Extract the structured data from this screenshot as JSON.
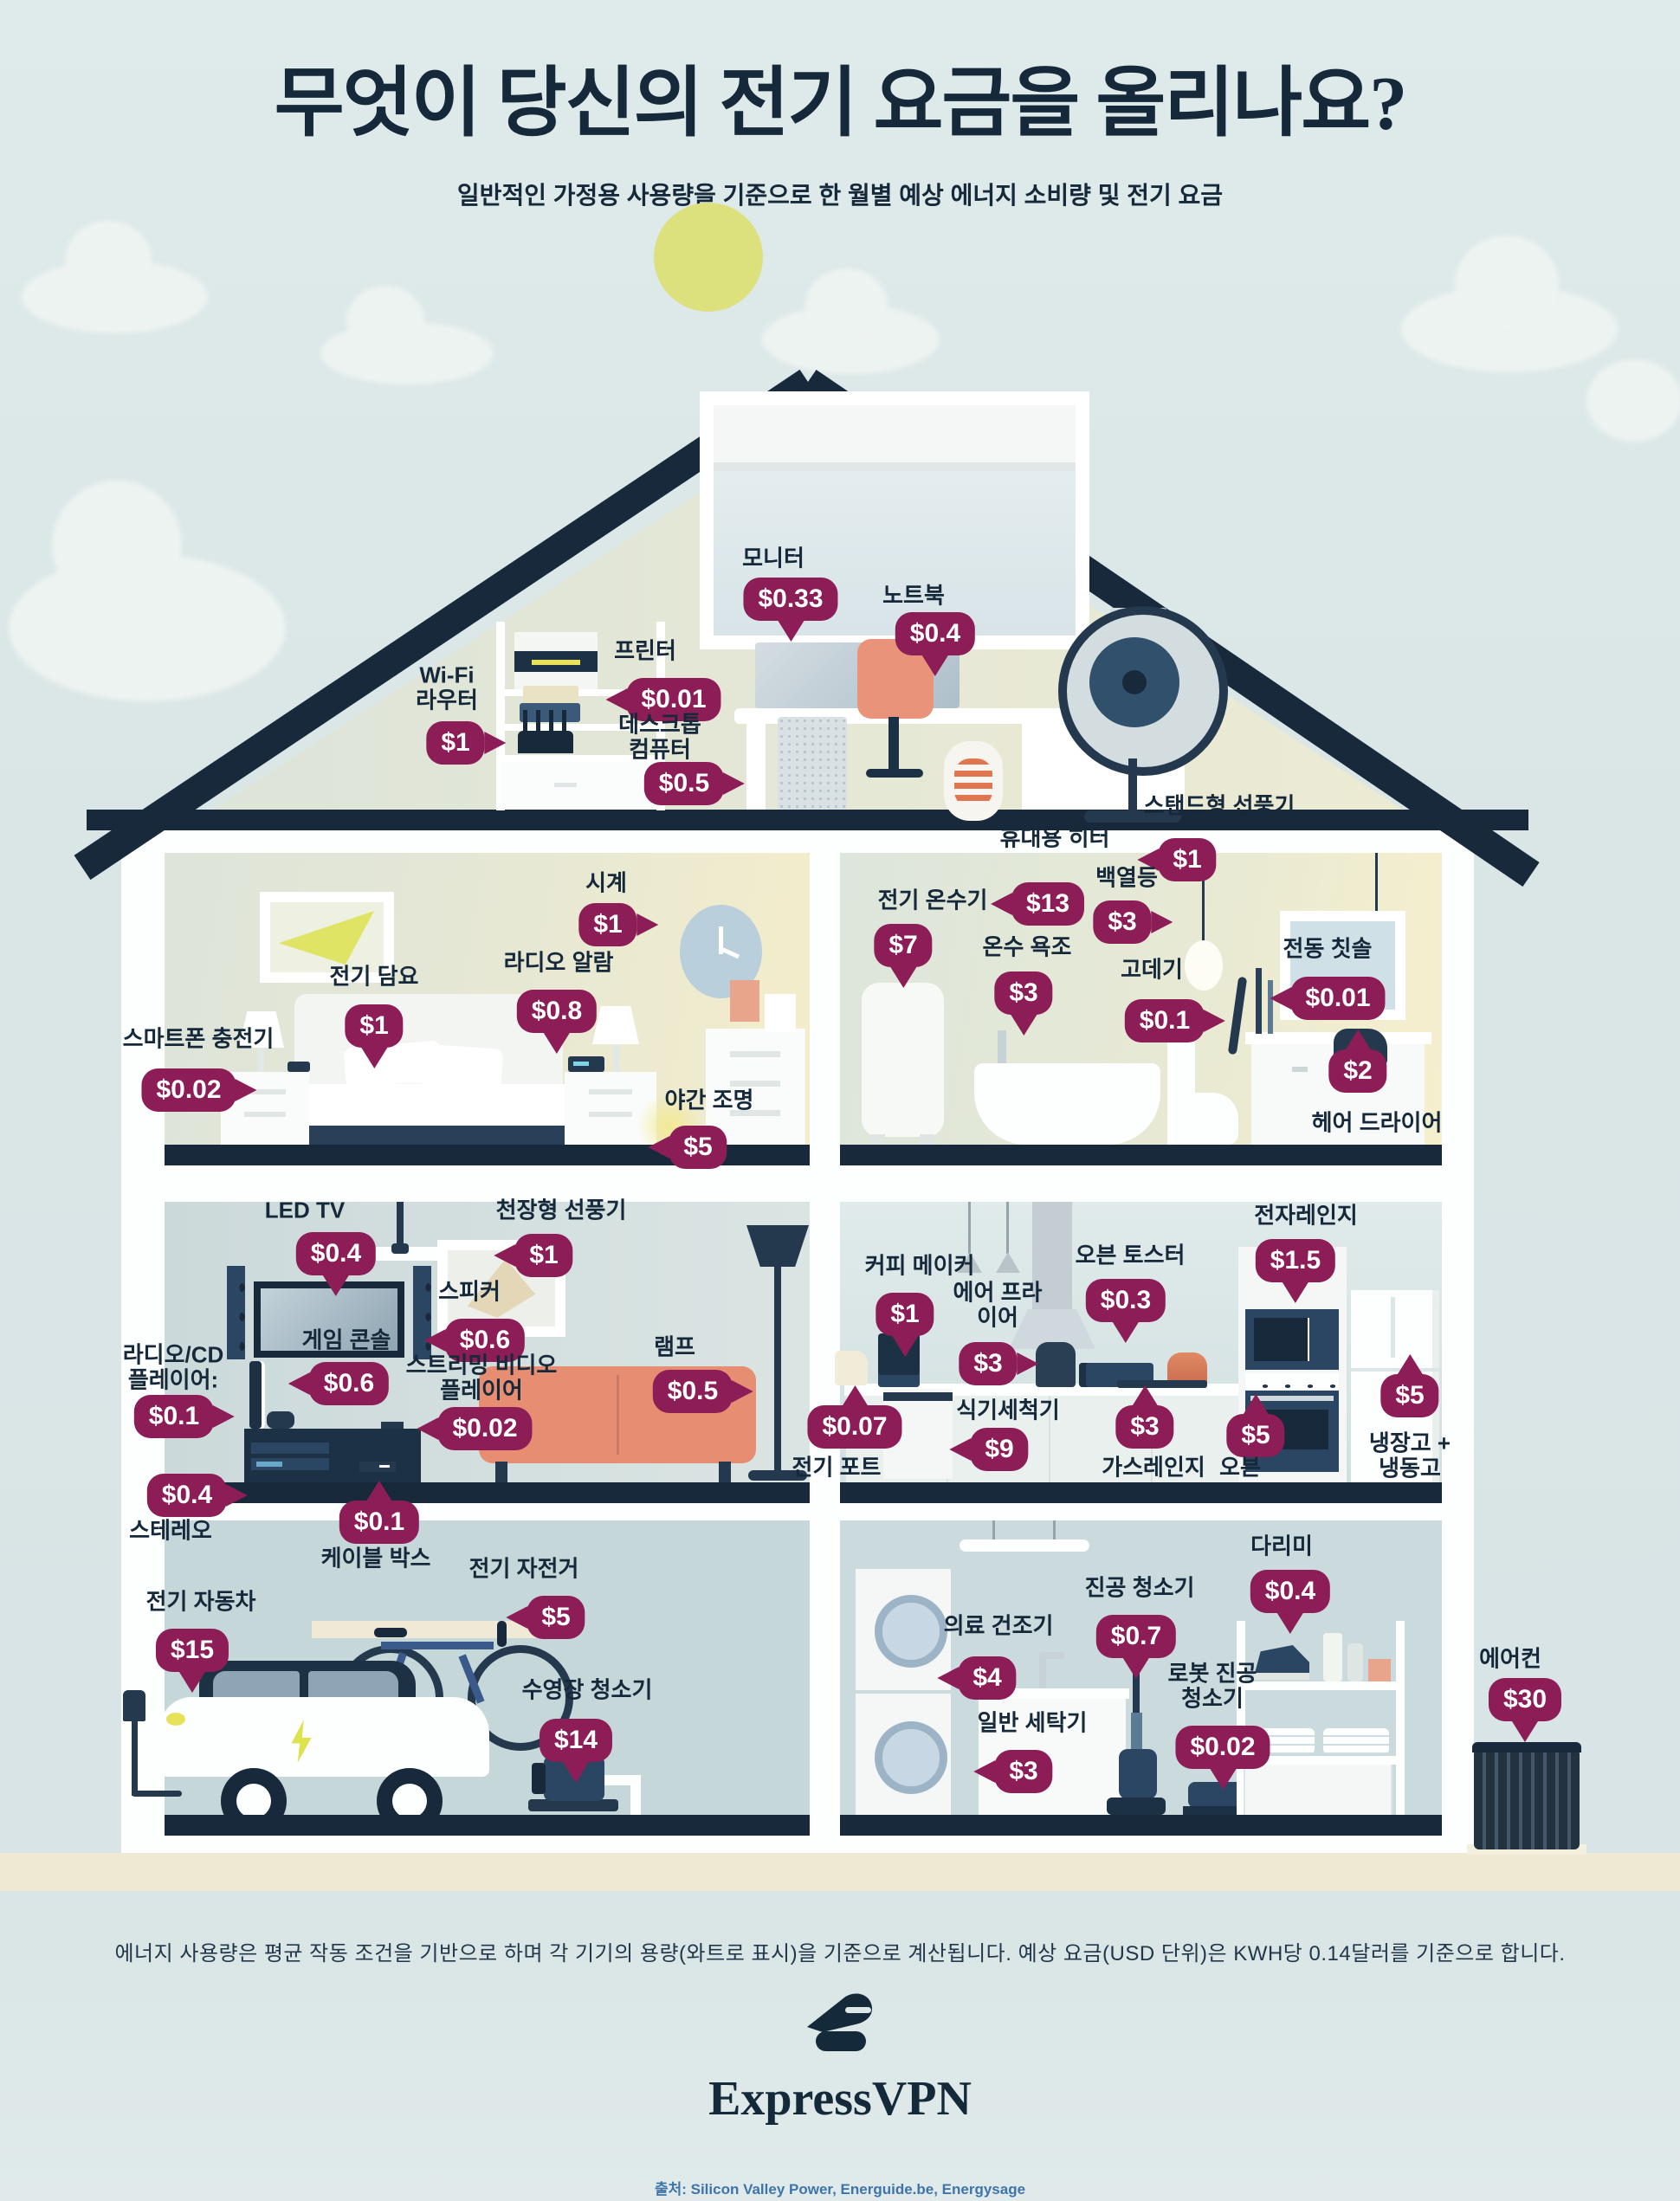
{
  "header": {
    "title": "무엇이 당신의 전기 요금을 올리나요?",
    "subtitle": "일반적인 가정용 사용량을 기준으로 한 월별 예상 에너지 소비량 및 전기 요금"
  },
  "items": [
    {
      "id": "monitor",
      "label": "모니터",
      "price": "$0.33"
    },
    {
      "id": "printer",
      "label": "프린터",
      "price": "$0.01"
    },
    {
      "id": "laptop",
      "label": "노트북",
      "price": "$0.4"
    },
    {
      "id": "wifi-router",
      "label": "Wi-Fi\n라우터",
      "price": "$1"
    },
    {
      "id": "desktop-computer",
      "label": "데스크톱\n컴퓨터",
      "price": "$0.5"
    },
    {
      "id": "portable-heater",
      "label": "휴대용 히터",
      "price": "$13"
    },
    {
      "id": "stand-fan",
      "label": "스탠드형 선풍기",
      "price": "$1"
    },
    {
      "id": "clock",
      "label": "시계",
      "price": "$1"
    },
    {
      "id": "electric-blanket",
      "label": "전기 담요",
      "price": "$1"
    },
    {
      "id": "radio-alarm",
      "label": "라디오 알람",
      "price": "$0.8"
    },
    {
      "id": "smartphone-charger",
      "label": "스마트폰 충전기",
      "price": "$0.02"
    },
    {
      "id": "night-light",
      "label": "야간 조명",
      "price": "$5"
    },
    {
      "id": "electric-water-heater",
      "label": "전기 온수기",
      "price": "$7"
    },
    {
      "id": "incandescent-bulb",
      "label": "백열등",
      "price": "$3"
    },
    {
      "id": "hot-tub",
      "label": "온수 욕조",
      "price": "$3"
    },
    {
      "id": "hair-straightener",
      "label": "고데기",
      "price": "$0.1"
    },
    {
      "id": "electric-toothbrush",
      "label": "전동 칫솔",
      "price": "$0.01"
    },
    {
      "id": "hair-dryer",
      "label": "헤어 드라이어",
      "price": "$2"
    },
    {
      "id": "led-tv",
      "label": "LED TV",
      "price": "$0.4"
    },
    {
      "id": "ceiling-fan",
      "label": "천장형 선풍기",
      "price": "$1"
    },
    {
      "id": "speakers",
      "label": "스피커",
      "price": "$0.6"
    },
    {
      "id": "game-console",
      "label": "게임 콘솔",
      "price": "$0.6"
    },
    {
      "id": "lamp",
      "label": "램프",
      "price": "$0.5"
    },
    {
      "id": "radio-cd-player",
      "label": "라디오/CD\n플레이어:",
      "price": "$0.1"
    },
    {
      "id": "stereo",
      "label": "스테레오",
      "price": "$0.4"
    },
    {
      "id": "streaming-player",
      "label": "스트리밍 비디오\n플레이어",
      "price": "$0.02"
    },
    {
      "id": "cable-box",
      "label": "케이블 박스",
      "price": "$0.1"
    },
    {
      "id": "coffee-maker",
      "label": "커피 메이커",
      "price": "$1"
    },
    {
      "id": "microwave",
      "label": "전자레인지",
      "price": "$1.5"
    },
    {
      "id": "oven-toaster",
      "label": "오븐 토스터",
      "price": "$0.3"
    },
    {
      "id": "air-fryer",
      "label": "에어 프라\n이어",
      "price": "$3"
    },
    {
      "id": "electric-kettle",
      "label": "전기 포트",
      "price": "$0.07"
    },
    {
      "id": "dishwasher",
      "label": "식기세척기",
      "price": "$9"
    },
    {
      "id": "gas-range",
      "label": "가스레인지",
      "price": "$3"
    },
    {
      "id": "oven",
      "label": "오븐",
      "price": "$5"
    },
    {
      "id": "fridge-freezer",
      "label": "냉장고 +\n냉동고",
      "price": "$5"
    },
    {
      "id": "electric-car",
      "label": "전기 자동차",
      "price": "$15"
    },
    {
      "id": "electric-bike",
      "label": "전기 자전거",
      "price": "$5"
    },
    {
      "id": "pool-cleaner",
      "label": "수영장 청소기",
      "price": "$14"
    },
    {
      "id": "clothes-dryer",
      "label": "의료 건조기",
      "price": "$4"
    },
    {
      "id": "vacuum-cleaner",
      "label": "진공 청소기",
      "price": "$0.7"
    },
    {
      "id": "iron",
      "label": "다리미",
      "price": "$0.4"
    },
    {
      "id": "robot-vacuum",
      "label": "로봇 진공\n청소기",
      "price": "$0.02"
    },
    {
      "id": "washing-machine",
      "label": "일반 세탁기",
      "price": "$3"
    },
    {
      "id": "air-conditioner",
      "label": "에어컨",
      "price": "$30"
    }
  ],
  "footer": {
    "disclaimer": "에너지 사용량은 평균 작동 조건을 기반으로 하며 각 기기의 용량(와트로 표시)을 기준으로 계산됩니다. 예상 요금(USD 단위)은 KWH당 0.14달러를 기준으로 합니다.",
    "brand": "ExpressVPN",
    "source": "출처: Silicon Valley Power, Energuide.be, Energysage"
  },
  "colors": {
    "badge": "#8c1d56",
    "navy": "#17293b",
    "sun": "#dce17d",
    "ground": "#efe9d4",
    "source_text": "#3f74ab"
  }
}
